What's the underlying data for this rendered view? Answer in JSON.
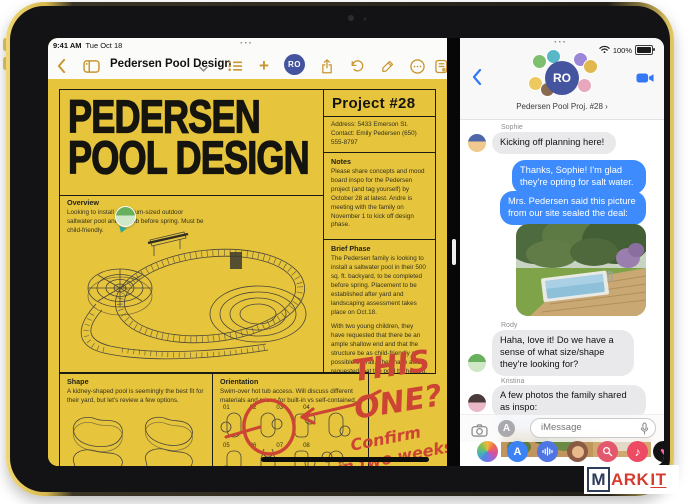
{
  "status": {
    "time": "9:41 AM",
    "date": "Tue Oct 18",
    "battery": "100%",
    "multitask_dots": "···"
  },
  "notes_app": {
    "toolbar": {
      "title": "Pedersen Pool Design",
      "collab_initials": "RO"
    },
    "poster": {
      "title_line1": "PEDERSEN",
      "title_line2": "POOL DESIGN",
      "project": {
        "heading": "Project #28",
        "address": "Address: 5433 Emerson St.",
        "contact": "Contact: Emily Pedersen (650) 555-8797",
        "notes_heading": "Notes",
        "notes_body": "Please share concepts and mood board inspo for the Pedersen project (and tag yourself) by October 28 at latest. Andre is meeting with the family on November 1 to kick off design phase.",
        "brief_heading": "Brief Phase",
        "brief_p1": "The Pedersen family is looking to install a saltwater pool in their 500 sq. ft. backyard, to be completed before spring. Placement to be established after yard and landscaping assessment takes place on Oct.18.",
        "brief_p2": "With two young children, they have requested that there be an ample shallow end and that the structure be as child-friendly as possible overall. They have also requested that the pool be heated, approximately 75 degrees at minimum.",
        "brief_p3": "Pool will definitely include hot tub, but orientation and access are to be determined.",
        "brief_p4": "Estimate will need to be generated after Andre meets with the family on Oct. 21 to review options."
      },
      "overview": {
        "heading": "Overview",
        "body": "Looking to install a medium-sized outdoor saltwater pool and hot tub before spring. Must be child-friendly."
      },
      "shape": {
        "heading": "Shape",
        "body": "A kidney-shaped pool is seemingly the best fit for their yard, but let's review a few options."
      },
      "orientation": {
        "heading": "Orientation",
        "body": "Swim-over hot tub access. Will discuss different materials and prices for built-in vs self-contained.",
        "row1": [
          "01",
          "02",
          "03",
          "04"
        ],
        "row2": [
          "05",
          "06",
          "07",
          "08"
        ]
      },
      "annotations": {
        "line1": "THIS",
        "line2": "ONE?",
        "line3": "Confirm",
        "line4": "in two weeks!"
      }
    }
  },
  "messages_app": {
    "nav": {
      "title": "Pedersen Pool Proj. #28",
      "collab_initials": "RO"
    },
    "thread": [
      {
        "sender": "Sophie",
        "text": "Kicking off planning here!"
      },
      {
        "text": "Thanks, Sophie! I'm glad they're opting for salt water."
      },
      {
        "text": "Mrs. Pedersen said this picture from our site sealed the deal:"
      },
      {
        "sender": "Rody",
        "text": "Haha, love it! Do we have a sense of what size/shape they're looking for?"
      },
      {
        "sender": "Kristina",
        "text": "A few photos the family shared as inspo:"
      }
    ],
    "photos_link": "12 Photos",
    "composer": {
      "placeholder": "iMessage"
    }
  },
  "colors": {
    "poster_yellow": "#e6c43c",
    "notes_tint": "#c8962e",
    "imessage_blue": "#3d8bfd",
    "marker_red": "#cc4433"
  },
  "watermark": {
    "m": "M",
    "ark": "ARK",
    "it": "IT"
  }
}
